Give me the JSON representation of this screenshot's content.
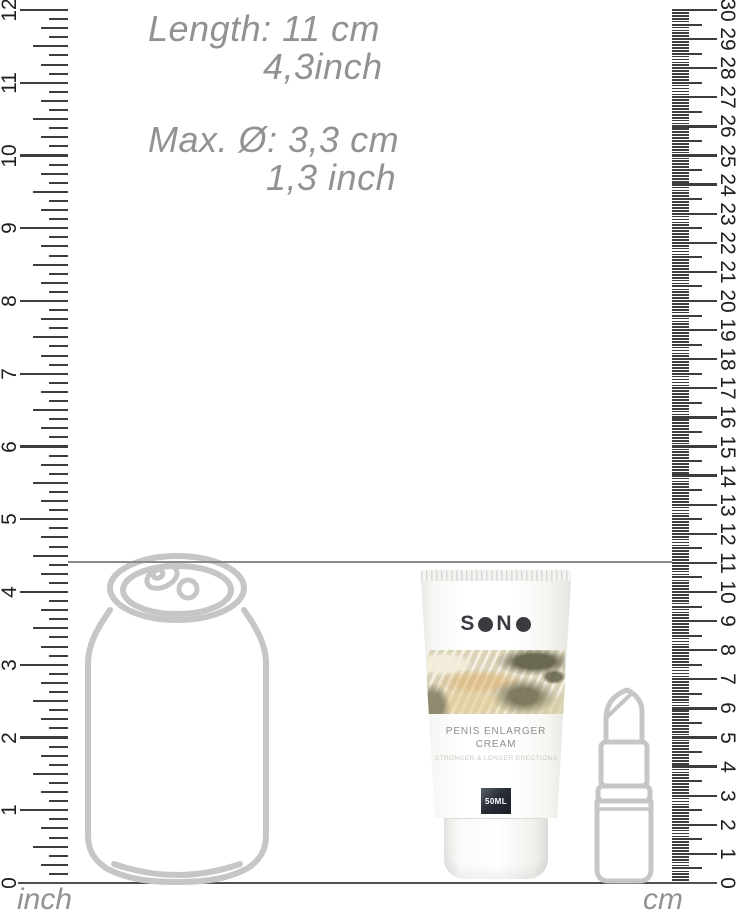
{
  "measurements": {
    "length_primary": "Length: 11 cm",
    "length_secondary": "4,3inch",
    "diameter_primary": "Max. Ø: 3,3 cm",
    "diameter_secondary": "1,3 inch",
    "indicator_value_cm": 11
  },
  "rulers": {
    "inch": {
      "unit_label": "inch",
      "min": 0,
      "max": 12,
      "labels": [
        "0",
        "1",
        "2",
        "3",
        "4",
        "5",
        "6",
        "7",
        "8",
        "9",
        "10",
        "11",
        "12"
      ]
    },
    "cm": {
      "unit_label": "cm",
      "min": 0,
      "max": 30,
      "labels": [
        "0",
        "1",
        "2",
        "3",
        "4",
        "5",
        "6",
        "7",
        "8",
        "9",
        "10",
        "11",
        "12",
        "13",
        "14",
        "15",
        "16",
        "17",
        "18",
        "19",
        "20",
        "21",
        "22",
        "23",
        "24",
        "25",
        "26",
        "27",
        "28",
        "29",
        "30"
      ]
    }
  },
  "product": {
    "brand": "SONO",
    "name_line1": "PENIS ENLARGER",
    "name_line2": "CREAM",
    "tagline": "STRONGER & LONGER ERECTIONS",
    "volume": "50ML"
  },
  "reference_objects": [
    "soda-can",
    "lipstick"
  ],
  "colors": {
    "ruler_ink": "#3d3d3d",
    "number_ink": "#1f1f1f",
    "annotation_gray": "#929292",
    "lineart_gray": "#c6c6c6",
    "brand_ink": "#3a3a41",
    "label_ink": "#8d8d8b",
    "badge_bg": "#23262e"
  }
}
